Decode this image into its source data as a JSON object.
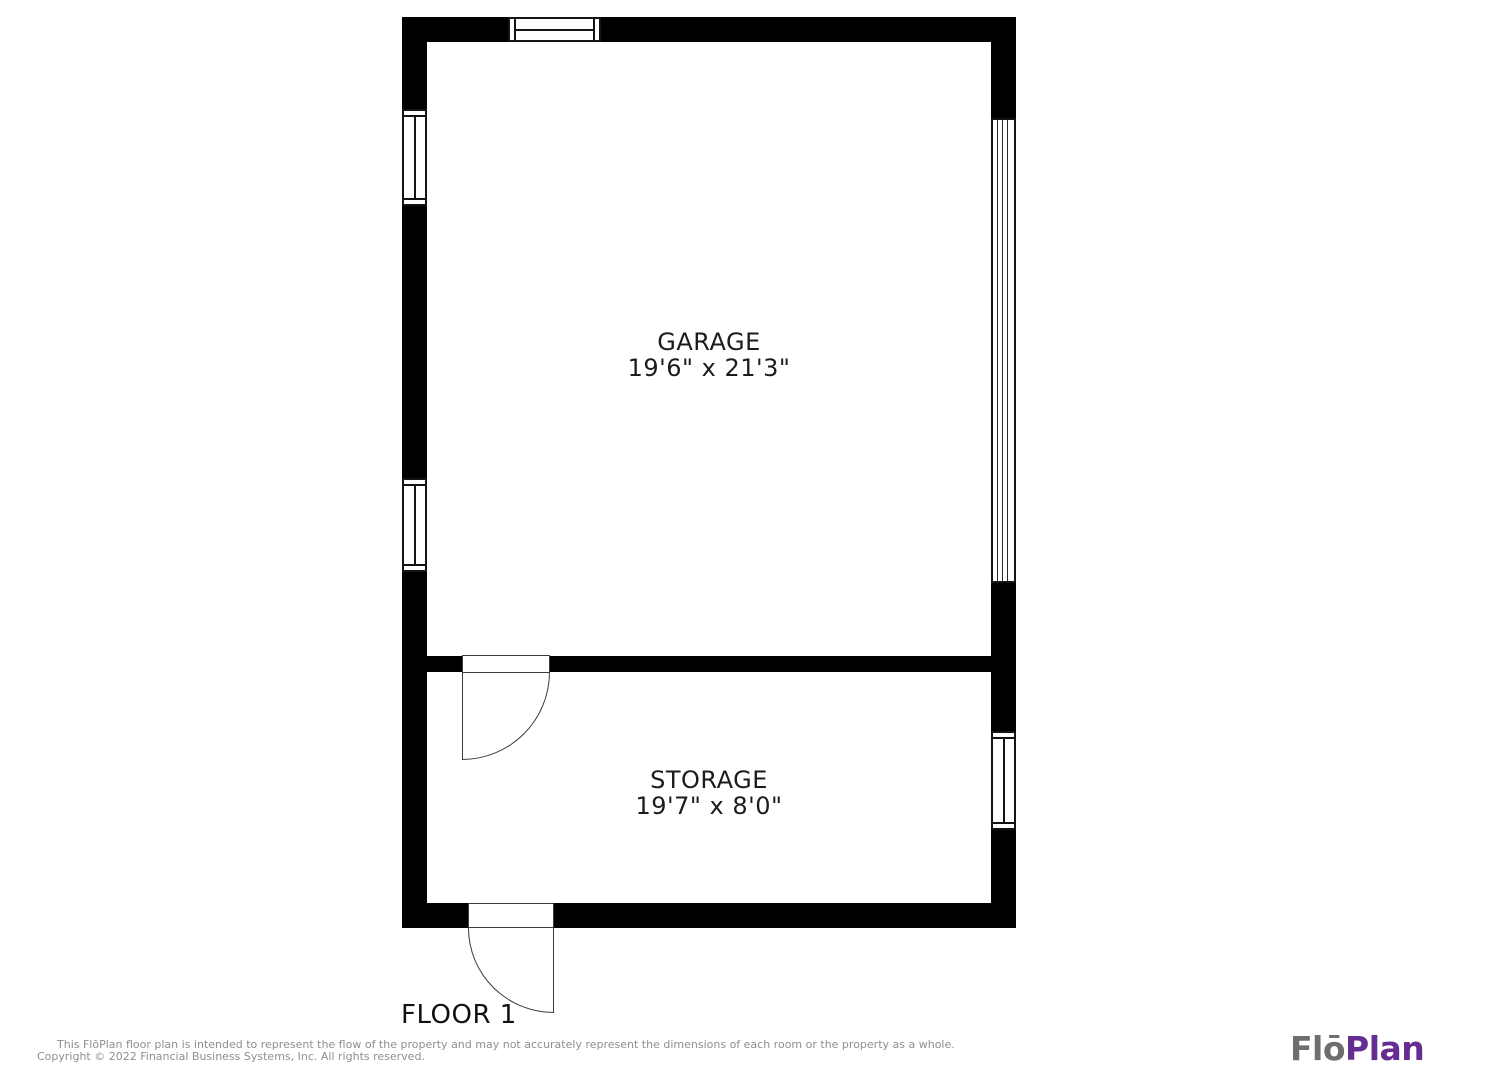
{
  "floor_label": "FLOOR 1",
  "rooms": [
    {
      "name": "GARAGE",
      "dimensions": "19'6\" x 21'3\""
    },
    {
      "name": "STORAGE",
      "dimensions": "19'7\" x 8'0\""
    }
  ],
  "footer": {
    "disclaimer_line1": "This FlōPlan floor plan is intended to represent the flow of the property and may not accurately represent the dimensions of each room or the property as a whole.",
    "disclaimer_line2": "Copyright © 2022 Financial Business Systems, Inc. All rights reserved.",
    "logo": {
      "part1": "Flō",
      "part2": "Plan",
      "part1_color": "#6e6e71",
      "part2_color": "#662d91"
    }
  },
  "colors": {
    "wall": "#000000",
    "plan_text": "#1c1c1c",
    "disclaimer_text": "#8f8f8f"
  }
}
